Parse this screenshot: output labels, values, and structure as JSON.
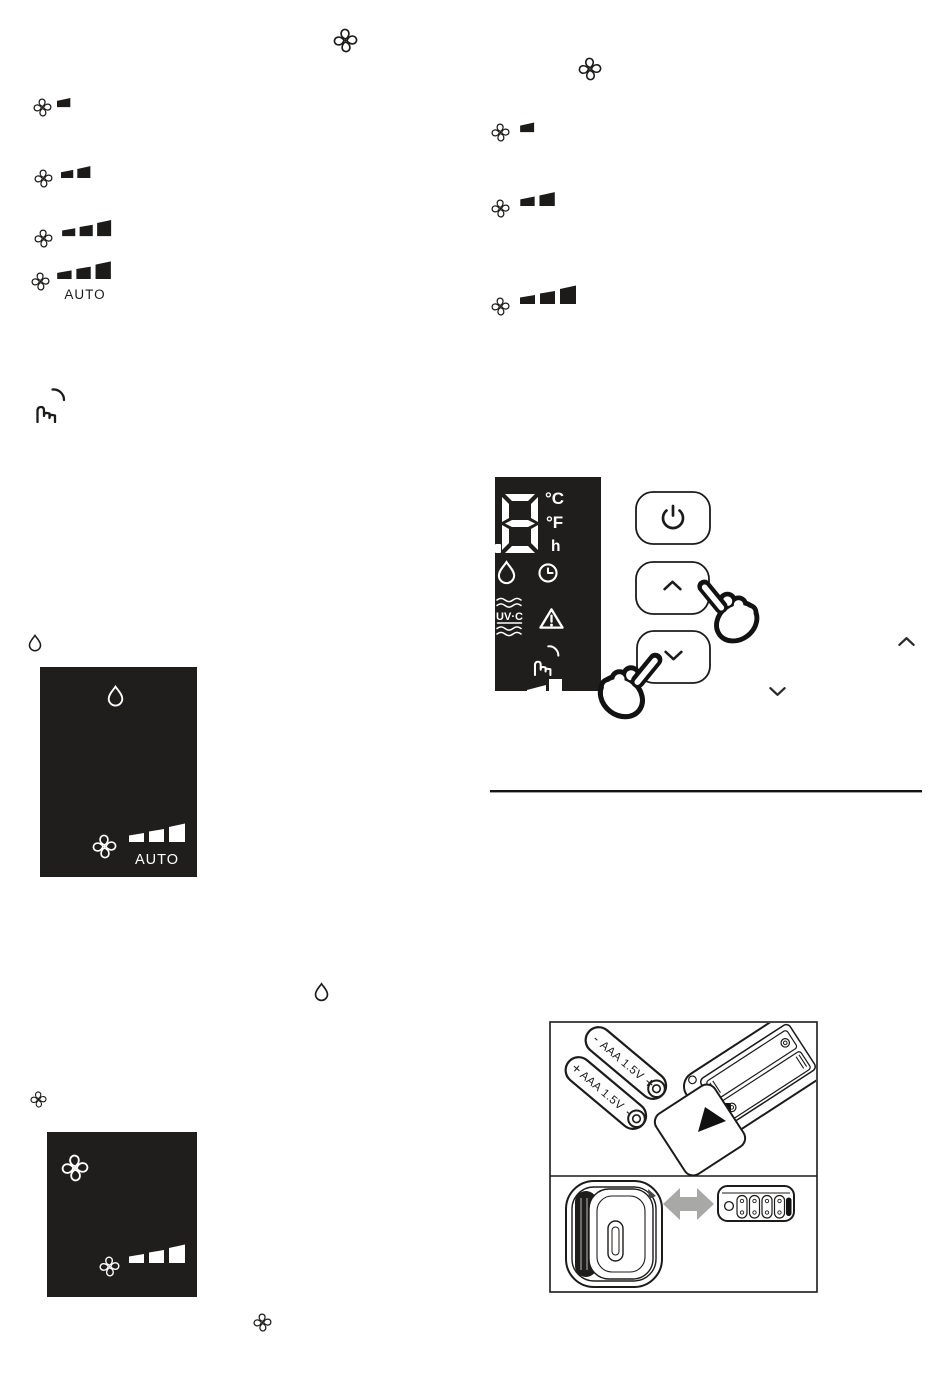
{
  "colors": {
    "paper": "#ffffff",
    "ink": "#1c1b1a",
    "panel_bg": "#201d1d",
    "arrow_gray": "#a8a8a7"
  },
  "fan_speed_legend_left": {
    "heading_icon": "fan-icon",
    "rows": [
      {
        "icon": "fan-icon",
        "bars": 1
      },
      {
        "icon": "fan-icon",
        "bars": 2
      },
      {
        "icon": "fan-icon",
        "bars": 3
      },
      {
        "icon": "fan-icon",
        "bars": 3,
        "label": "AUTO"
      }
    ]
  },
  "fan_speed_legend_right": {
    "heading_icon": "fan-icon",
    "rows": [
      {
        "icon": "fan-icon",
        "bars": 1
      },
      {
        "icon": "fan-icon",
        "bars": 2
      },
      {
        "icon": "fan-icon",
        "bars": 3
      }
    ]
  },
  "margin_icons": {
    "touch_hand": "touch-hand-icon",
    "water_drop_left": "water-drop-icon",
    "water_drop_middle": "water-drop-icon",
    "fan_small_left": "fan-icon",
    "fan_bottom": "fan-icon"
  },
  "display_figure": {
    "digit": "8",
    "units": {
      "celsius": "°C",
      "fahrenheit": "°F",
      "hours": "h"
    },
    "uvc_label": "UV·C",
    "indicators": [
      "water-drop-icon",
      "timer-clock-icon",
      "uv-c-indicator",
      "warning-triangle-icon",
      "touch-hand-icon",
      "fan-speed-bars"
    ],
    "buttons": [
      {
        "id": "power",
        "icon": "power-icon"
      },
      {
        "id": "up",
        "icon": "chevron-up-icon"
      },
      {
        "id": "down",
        "icon": "chevron-down-icon"
      }
    ]
  },
  "inline_symbols": {
    "caret_up": "^",
    "caret_down": "v"
  },
  "auto_mode_panel": {
    "top_icon": "water-drop-icon",
    "fan_icon": "fan-icon",
    "bars": 3,
    "label": "AUTO"
  },
  "fan_mode_panel": {
    "top_icon": "fan-icon",
    "fan_icon": "fan-icon",
    "bars": 3
  },
  "battery_figure": {
    "batteries": [
      {
        "sign_start": "-",
        "label": "AAA 1.5V",
        "sign_end": "+"
      },
      {
        "sign_start": "+",
        "label": "AAA 1.5V",
        "sign_end": "-"
      }
    ]
  }
}
